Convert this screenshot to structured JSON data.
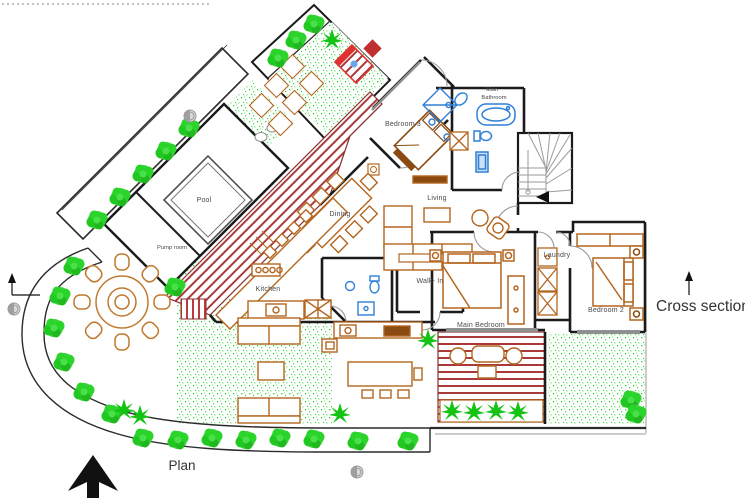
{
  "drawing": {
    "labels": {
      "pool": "Pool",
      "pump_room": "Pump room",
      "bedroom3": "Bedroom 3",
      "main_bathroom_1": "Main",
      "main_bathroom_2": "Bathroom",
      "living": "Living",
      "dining": "Dining",
      "kitchen": "Kitchen",
      "walk_in": "Walk- In",
      "laundry": "Laundry",
      "main_bedroom": "Main Bedroom",
      "bedroom2": "Bedroom 2"
    },
    "annotations": {
      "plan": "Plan",
      "cross_section": "Cross section"
    },
    "colors": {
      "walls": "#1b1b1b",
      "furniture": "#b4651e",
      "furniture_dark": "#8a4a12",
      "deck_stripes": "#aa3a3a",
      "lounger_red": "#e03030",
      "vegetation": "#2fd32f",
      "fixtures_blue": "#2f7fd6",
      "stairs_gray": "#9a9a9a"
    }
  }
}
